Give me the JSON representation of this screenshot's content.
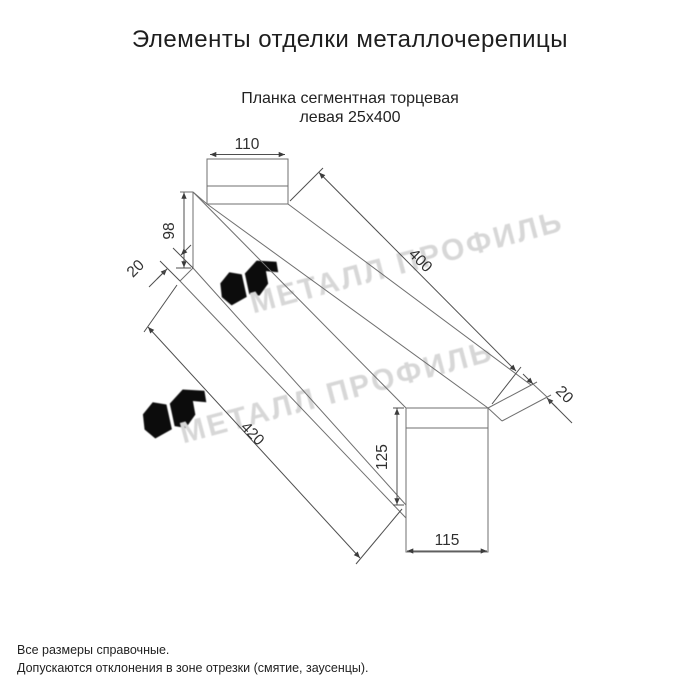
{
  "title": "Элементы отделки металлочерепицы",
  "subtitle": {
    "line1": "Планка сегментная торцевая",
    "line2": "левая 25х400"
  },
  "drawing": {
    "type": "technical-dimension-drawing",
    "dims": {
      "left_end_width": "110",
      "left_end_height": "98",
      "left_hem": "20",
      "top_length": "400",
      "bottom_length": "420",
      "right_hem": "20",
      "right_end_height": "125",
      "right_end_width": "115"
    }
  },
  "watermark": {
    "text": "МЕТАЛЛ ПРОФИЛЬ",
    "color": "#d5d5d5"
  },
  "notes": {
    "line1": "Все размеры справочные.",
    "line2": "Допускаются отклонения в зоне отрезки (смятие, заусенцы)."
  },
  "colors": {
    "background": "#ffffff",
    "part_line": "#6f6f6f",
    "dim_line": "#4f4f4f",
    "dim_text": "#303030",
    "page_text": "#1e1e1e"
  }
}
